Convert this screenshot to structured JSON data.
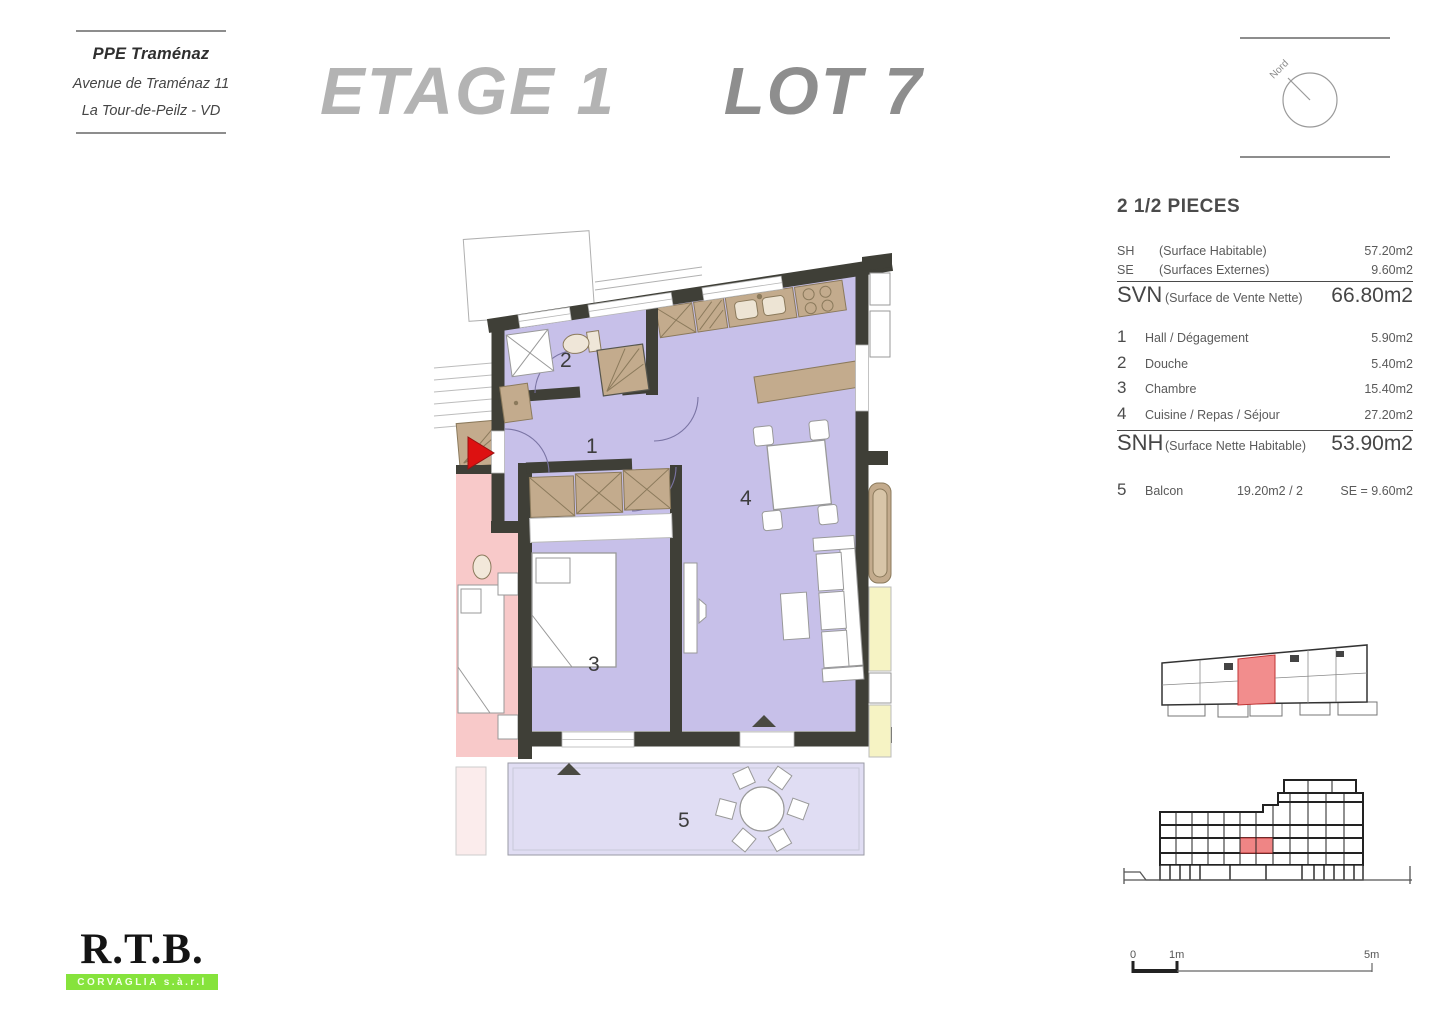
{
  "header": {
    "project_name": "PPE Traménaz",
    "address_line_1": "Avenue de Traménaz 11",
    "address_line_2": "La Tour-de-Peilz - VD",
    "title_left": "ETAGE 1",
    "title_right": "LOT 7",
    "compass_label": "Nord"
  },
  "summary_panel": {
    "apartment_type": "2 1/2 PIECES",
    "surfaces": [
      {
        "code": "SH",
        "label": "(Surface Habitable)",
        "value": "57.20m2"
      },
      {
        "code": "SE",
        "label": "(Surfaces Externes)",
        "value": "9.60m2"
      },
      {
        "code": "SVN",
        "label": "(Surface de Vente Nette)",
        "value": "66.80m2"
      }
    ],
    "rooms": [
      {
        "num": "1",
        "label": "Hall / Dégagement",
        "value": "5.90m2"
      },
      {
        "num": "2",
        "label": "Douche",
        "value": "5.40m2"
      },
      {
        "num": "3",
        "label": "Chambre",
        "value": "15.40m2"
      },
      {
        "num": "4",
        "label": "Cuisine / Repas / Séjour",
        "value": "27.20m2"
      }
    ],
    "snh": {
      "code": "SNH",
      "label": "(Surface Nette Habitable)",
      "value": "53.90m2"
    },
    "balcony": {
      "num": "5",
      "label": "Balcon",
      "detail": "19.20m2 / 2",
      "value": "SE = 9.60m2"
    }
  },
  "plan": {
    "labels": {
      "r1": "1",
      "r2": "2",
      "r3": "3",
      "r4": "4",
      "r5": "5"
    }
  },
  "scale_bar": {
    "tick_0": "0",
    "tick_1": "1m",
    "tick_5": "5m"
  },
  "logo": {
    "name": "R.T.B.",
    "subtitle": "CORVAGLIA s.à.r.l"
  },
  "colors": {
    "unit_fill": "#c7c0e9",
    "balcony_fill": "#e0ddf3",
    "wall": "#3f3f37",
    "furniture_tan": "#c3ab8d",
    "neighbor_pink": "#f8c9c9",
    "neighbor_yellow": "#f6f3c4",
    "highlight_red": "#f28d8d",
    "entrance_arrow": "#dd1111",
    "logo_green": "#86e33c",
    "title_light_gray": "#b3b3b3",
    "title_dark_gray": "#8e8e8e"
  }
}
